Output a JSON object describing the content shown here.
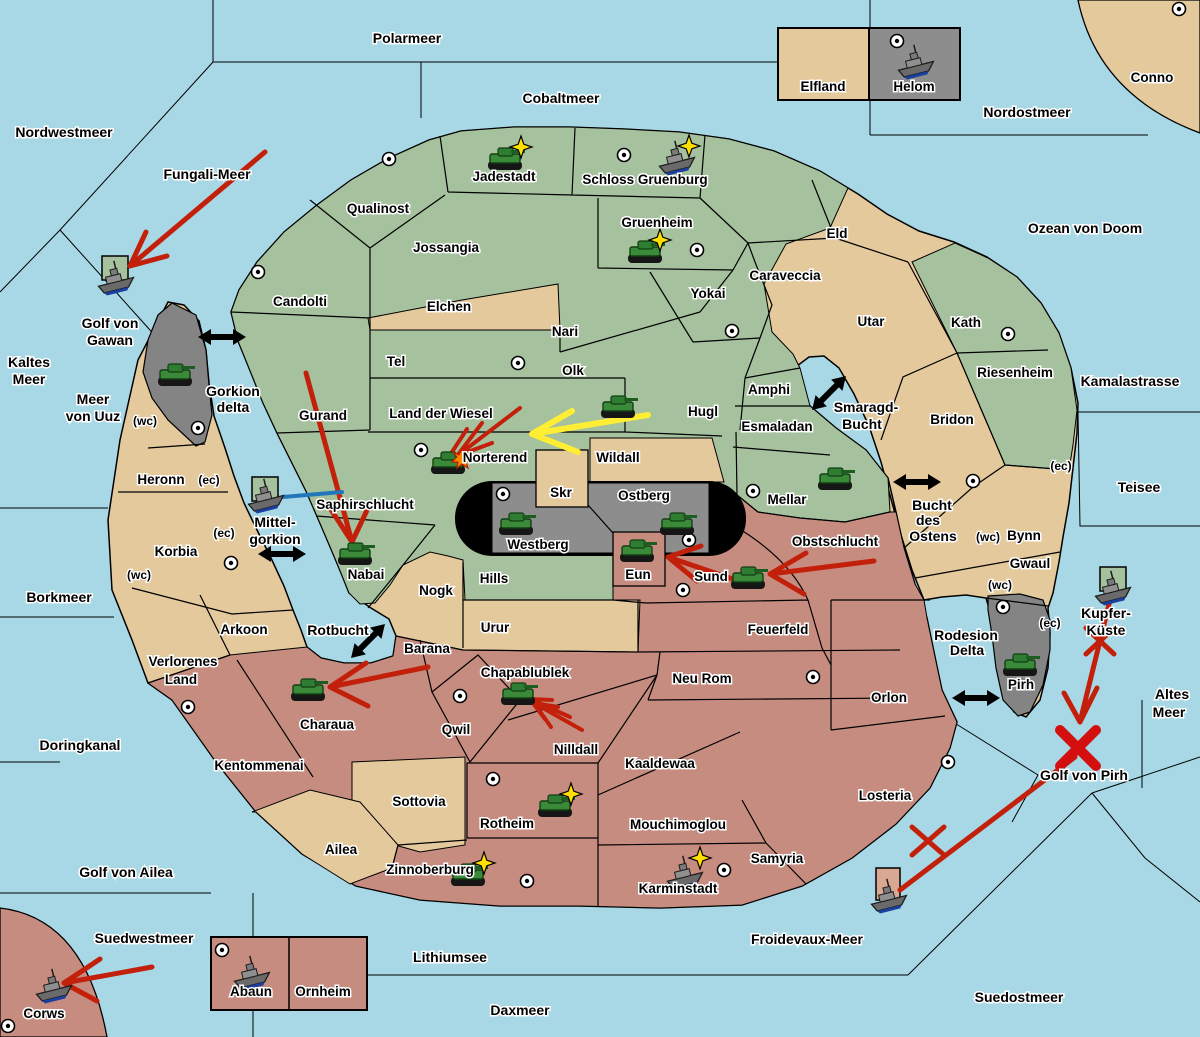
{
  "colors": {
    "sea": "#a8d8e6",
    "land_green": "#a5c19d",
    "land_tan": "#e3c99c",
    "land_pink": "#c78c80",
    "land_gray": "#848484",
    "mountain_black": "#000000",
    "attack_arrow_red": "#c2200a",
    "attack_arrow_yellow": "#ffee33",
    "sea_move_blue": "#2277bb",
    "unit_star_yellow": "#ffe000"
  },
  "sea": [
    "Polarmeer",
    "Nordwestmeer",
    "Fungali-Meer",
    "Cobaltmeer",
    "Nordostmeer",
    "Ozean von Doom",
    "Kamalastrasse",
    "Teisee",
    "Borkmeer",
    "Rotbucht",
    "Doringkanal",
    "Golf von Ailea",
    "Suedwestmeer",
    "Lithiumsee",
    "Daxmeer",
    "Froidevaux-Meer",
    "Suedostmeer",
    "Golf von Pirh",
    "Kaltes",
    "Meer",
    "Meer",
    "von Uuz",
    "Golf von",
    "Gawan",
    "Gorkion",
    "delta",
    "Mittel-",
    "gorkion",
    "Bucht",
    "des",
    "Ostens",
    "Smaragd-",
    "Bucht",
    "Altes",
    "Meer",
    "Kupfer-",
    "Küste",
    "Rodesion",
    "Delta"
  ],
  "land": [
    "Jadestadt",
    "Schloss Gruenburg",
    "Qualinost",
    "Jossangia",
    "Candolti",
    "Gruenheim",
    "Yokai",
    "Caraveccia",
    "Eld",
    "Conno",
    "Elfland",
    "Helom",
    "Utar",
    "Kath",
    "Riesenheim",
    "Bridon",
    "Bynn",
    "Gwaul",
    "Elchen",
    "Tel",
    "Nari",
    "Olk",
    "Land der Wiesel",
    "Hugl",
    "Amphi",
    "Esmaladan",
    "Wildall",
    "Norterend",
    "Mellar",
    "Gurand",
    "Saphirschlucht",
    "Nabai",
    "Hills",
    "Nogk",
    "Urur",
    "Skr",
    "Westberg",
    "Ostberg",
    "Eun",
    "Sund",
    "Obstschlucht",
    "Feuerfeld",
    "Heronn",
    "Korbia",
    "Arkoon",
    "Verlorenes",
    "Land",
    "Kentommenai",
    "Charaua",
    "Barana",
    "Qwil",
    "Chapablublek",
    "Nilldall",
    "Kaaldewaa",
    "Neu Rom",
    "Sottovia",
    "Rotheim",
    "Mouchimoglou",
    "Zinnoberburg",
    "Ailea",
    "Karminstadt",
    "Samyria",
    "Losteria",
    "Orlon",
    "Pirh",
    "Corws",
    "Abaun",
    "Ornheim"
  ],
  "straits": [
    "(wc)",
    "(ec)",
    "(ec)",
    "(wc)",
    "(ec)",
    "(wc)",
    "(wc)",
    "(ec)"
  ],
  "units": [
    {
      "type": "tank",
      "location": "Jadestadt",
      "star": true
    },
    {
      "type": "ship",
      "location": "Schloss Gruenburg",
      "star": true
    },
    {
      "type": "tank",
      "location": "Gruenheim",
      "star": true
    },
    {
      "type": "ship",
      "location": "Helom"
    },
    {
      "type": "ship",
      "location": "Golf von Gawan"
    },
    {
      "type": "tank",
      "location": "Gawar"
    },
    {
      "type": "ship",
      "location": "Mittel-gorkion"
    },
    {
      "type": "tank",
      "location": "Hugl"
    },
    {
      "type": "tank",
      "location": "Norterend",
      "status": "under-attack"
    },
    {
      "type": "tank",
      "location": "Nabai"
    },
    {
      "type": "tank",
      "location": "Westberg"
    },
    {
      "type": "tank",
      "location": "Ostberg"
    },
    {
      "type": "tank",
      "location": "Eun"
    },
    {
      "type": "tank",
      "location": "Sund"
    },
    {
      "type": "tank",
      "location": "Mellar"
    },
    {
      "type": "tank",
      "location": "Charaua"
    },
    {
      "type": "tank",
      "location": "Chapablublek"
    },
    {
      "type": "tank",
      "location": "Rotheim",
      "star": true
    },
    {
      "type": "tank",
      "location": "Zinnoberburg",
      "star": true
    },
    {
      "type": "ship",
      "location": "Karminstadt",
      "star": true
    },
    {
      "type": "tank",
      "location": "Pirh"
    },
    {
      "type": "ship",
      "location": "Kupfer-Küste"
    },
    {
      "type": "ship",
      "location": "Froidevaux-Meer"
    },
    {
      "type": "ship",
      "location": "Corws"
    },
    {
      "type": "ship",
      "location": "Abaun"
    }
  ],
  "arrows": [
    {
      "color": "red",
      "from": "Fungali-Meer",
      "to": "Golf von Gawan"
    },
    {
      "color": "red",
      "from": "Gurand",
      "to": "Nabai"
    },
    {
      "color": "red",
      "from": "Olk",
      "to": "Norterend"
    },
    {
      "color": "yellow",
      "from": "Hugl",
      "to": "Norterend"
    },
    {
      "color": "red",
      "from": "Obstschlucht",
      "to": "Sund"
    },
    {
      "color": "red",
      "from": "Sund",
      "to": "Eun"
    },
    {
      "color": "red",
      "from": "Barana",
      "to": "Charaua"
    },
    {
      "color": "red",
      "from": "Nilldall",
      "to": "Chapablublek"
    },
    {
      "color": "red",
      "from": "Suedwestmeer",
      "to": "Corws"
    },
    {
      "color": "red",
      "from": "Kupfer-Küste",
      "to": "Golf von Pirh",
      "note": "crossed-out"
    },
    {
      "color": "red",
      "from": "Golf von Pirh",
      "to": "Froidevaux-Meer ship",
      "note": "crossed-out"
    },
    {
      "color": "blue",
      "from": "Mittel-gorkion ship",
      "to": "Saphirschlucht"
    }
  ],
  "sea_crossings": [
    "Gorkion delta",
    "Mittel-gorkion",
    "Rotbucht",
    "Smaragd-Bucht",
    "Bucht des Ostens",
    "Rodesion Delta"
  ],
  "city_markers": [
    "Jadestadt",
    "Schloss Gruenburg",
    "Conno",
    "Helom",
    "Gruenheim",
    "Yokai",
    "Candolti",
    "Kath",
    "Tel",
    "Gawar",
    "Norterend",
    "Westberg",
    "Ostberg",
    "Mellar",
    "Bridon",
    "Sund",
    "Korbia",
    "Kentommenai",
    "Qwil",
    "Rotheim",
    "Zinnoberburg",
    "Karminstadt",
    "Losteria",
    "Orlon",
    "Pirh",
    "Corws",
    "Abaun"
  ]
}
